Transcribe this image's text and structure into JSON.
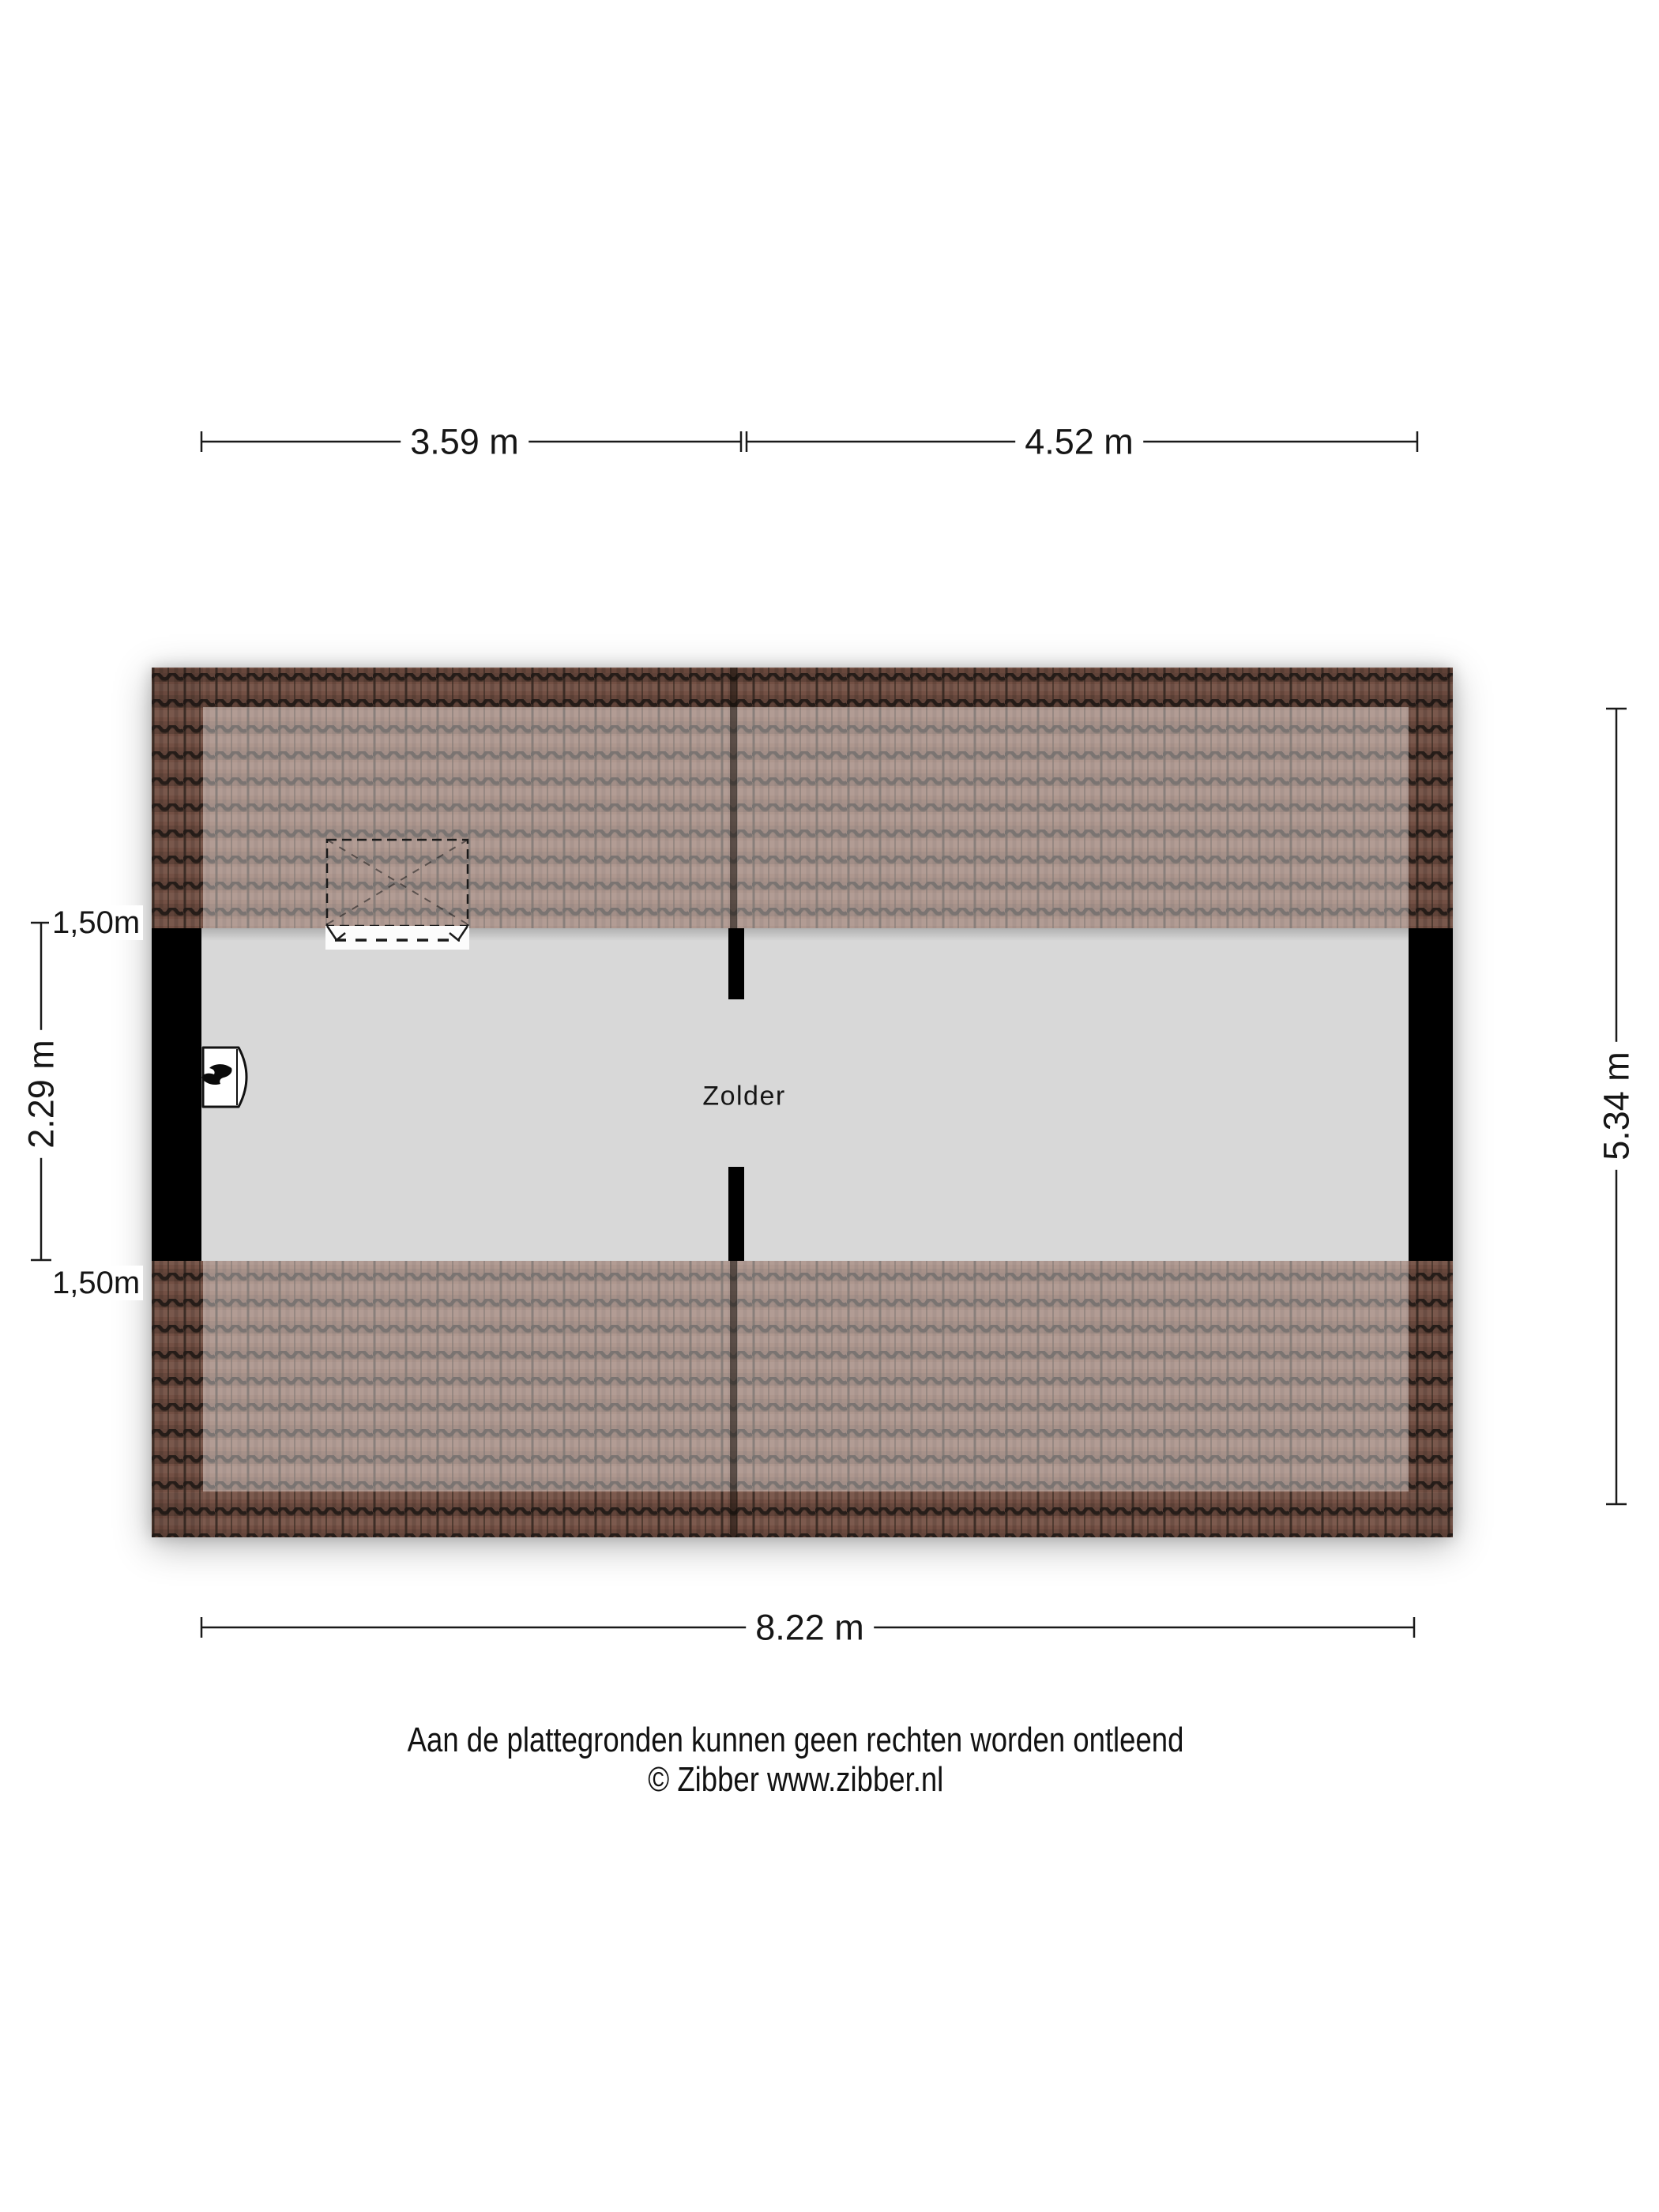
{
  "room": {
    "label": "Zolder"
  },
  "dimensions": {
    "top_segment_1": "3.59 m",
    "top_segment_2": "4.52 m",
    "bottom_total": "8.22 m",
    "left_room_height": "2.29 m",
    "left_knee_wall_top": "1,50m",
    "left_knee_wall_bottom": "1,50m",
    "right_total_depth": "5.34 m"
  },
  "footer": {
    "disclaimer": "Aan de plattegronden kunnen geen rechten worden ontleend",
    "copyright": "© Zibber www.zibber.nl"
  },
  "icons": {
    "boiler": "flame-icon",
    "roof_window": "dashed-roof-window-outline"
  },
  "colors": {
    "tile_base": "#7d574a",
    "tile_line": "#241c18",
    "room_floor": "#d8d8d8",
    "wall": "#000000",
    "dim_line": "#1a1a1a",
    "text": "#161616"
  }
}
